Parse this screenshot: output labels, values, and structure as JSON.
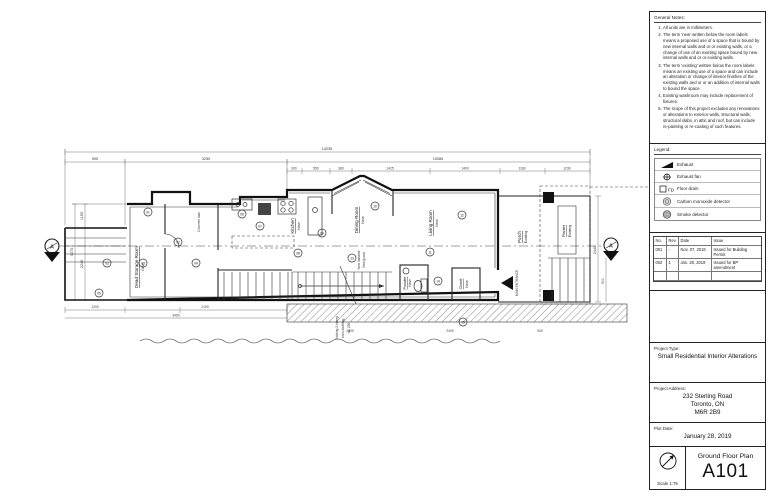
{
  "plan": {
    "rooms": [
      {
        "name": "Dead Storage Room",
        "status": "New"
      },
      {
        "name": "Kitchen",
        "status": "New"
      },
      {
        "name": "Dining Room",
        "status": "New"
      },
      {
        "name": "Living Room",
        "status": "New"
      },
      {
        "name": "Powder",
        "status": "New"
      },
      {
        "name": "Closet",
        "status": "New"
      },
      {
        "name": "Porch",
        "status": "Existing"
      },
      {
        "name": "Planter",
        "status": "Existing"
      }
    ],
    "annotations": {
      "main_entrance": "MAIN ENTRANCE",
      "concrete_slab": "Concrete slab",
      "stair_note_1": "New handrail",
      "stair_note_2": "New guard",
      "neighbour_line_1": "Existing 2-storey",
      "neighbour_line_2": "brick dwelling,",
      "neighbour_line_3": "no. 230"
    },
    "section_marker": "A",
    "keynotes": [
      "01",
      "02",
      "03",
      "03",
      "04",
      "05",
      "06",
      "07",
      "08",
      "09",
      "10",
      "11",
      "12",
      "13",
      "14",
      "15"
    ],
    "dimensions": {
      "overall_top": "14235",
      "top": [
        "900",
        "3250",
        "10085"
      ],
      "top_sub": [
        "300",
        "550",
        "380",
        "1425",
        "1400",
        "1180",
        "1230"
      ],
      "left": [
        "1150",
        "2240",
        "4270"
      ],
      "bottom": [
        "1200",
        "2150",
        "3450",
        "2400",
        "2400",
        "940",
        "900"
      ],
      "porch": "2440"
    }
  },
  "titleblock": {
    "general_notes": {
      "title": "General Notes:",
      "items": [
        "All units are in millimeters.",
        "The term 'new' written below the room labels means a proposed use of a space that is bound by new internal walls and or or existing walls, or a change of use of an existing space bound by new internal walls and or or existing walls.",
        "The term 'existing' written below the room labels means an existing use of a space and can include an alteration or change of interior finishes of the existing walls and or or an addition of internal walls to bound the space.",
        "Existing washroom may include replacement of fixtures.",
        "The scope of this project excludes any renovations or alterations to exterior walls, structural walls, structural slabs, in attic and roof, but can include re-painting or re-coating of such features."
      ]
    },
    "legend": {
      "title": "Legend:",
      "floor_drain_tag": "FD",
      "items": [
        {
          "icon": "exhaust-icon",
          "label": "Exhaust"
        },
        {
          "icon": "exhaust-fan-icon",
          "label": "Exhaust fan"
        },
        {
          "icon": "floor-drain-icon",
          "label": "Floor drain"
        },
        {
          "icon": "co-detector-icon",
          "label": "Carbon monoxide detector"
        },
        {
          "icon": "smoke-detector-icon",
          "label": "Smoke detector"
        }
      ]
    },
    "revisions": {
      "headers": [
        "No.",
        "Rev.",
        "Date",
        "Issue"
      ],
      "rows": [
        {
          "no": "001",
          "rev": "-",
          "date": "Nov. 07, 2018",
          "issue": "Issued for Building Permit"
        },
        {
          "no": "002",
          "rev": "1",
          "date": "Jan. 28, 2019",
          "issue": "Issued for BP amendment"
        }
      ]
    },
    "project_type": {
      "label": "Project Type:",
      "value": "Small Residential Interior Alterations"
    },
    "project_address": {
      "label": "Project Address:",
      "lines": [
        "232 Sterling Road",
        "Toronto, ON",
        "M6R 2B9"
      ]
    },
    "plot_date": {
      "label": "Plot Date:",
      "value": "January 28, 2019"
    },
    "drawing": {
      "scale": "Scale 1:75",
      "title": "Ground Floor Plan",
      "number": "A101"
    }
  }
}
